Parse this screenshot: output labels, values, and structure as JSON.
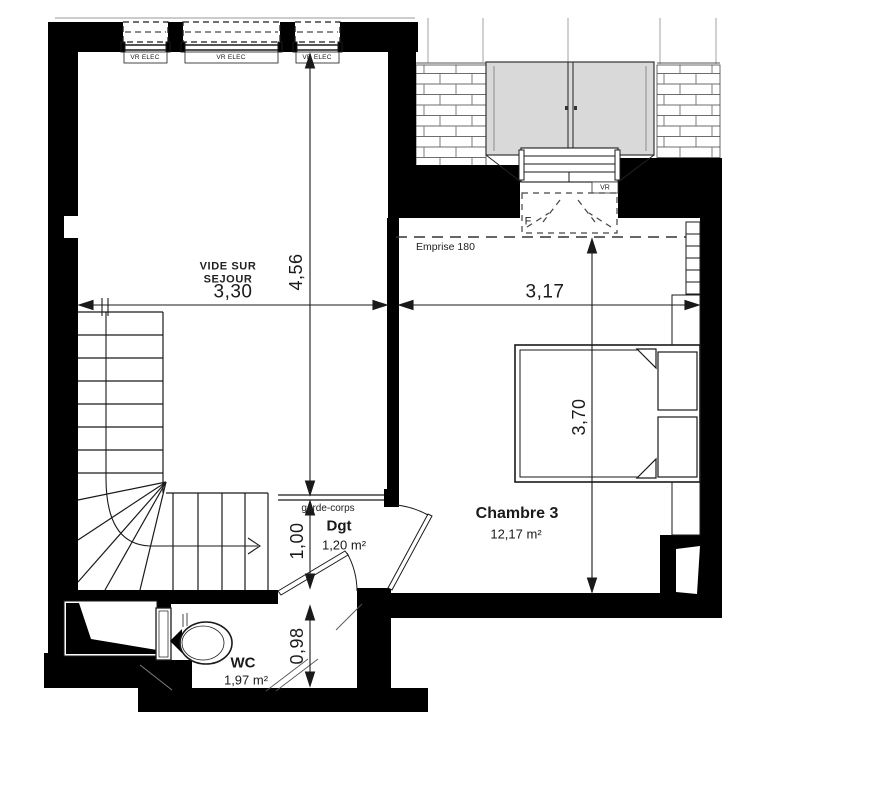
{
  "plan": {
    "type": "floor-plan",
    "rooms": {
      "vide_sur_sejour": {
        "name_line1": "VIDE SUR",
        "name_line2": "SEJOUR"
      },
      "chambre3": {
        "name": "Chambre 3",
        "area": "12,17 m²"
      },
      "dgt": {
        "name": "Dgt",
        "area": "1,20 m²"
      },
      "wc": {
        "name": "WC",
        "area": "1,97 m²"
      }
    },
    "dimensions": {
      "d330": "3,30",
      "d456": "4,56",
      "d317": "3,17",
      "d370": "3,70",
      "d100": "1,00",
      "d098": "0,98"
    },
    "labels": {
      "emprise": "Emprise 180",
      "garde_corps": "garde-corps",
      "window_type": "F",
      "roller_shutter": "VR"
    },
    "windows": [
      {
        "label": "VR ELEC"
      },
      {
        "label": "VR ELEC"
      },
      {
        "label": "VR ELEC"
      }
    ],
    "colors": {
      "wall": "#000000",
      "line": "#1a1a1a",
      "panel_gray": "#d9d9d9",
      "mortar": "#6e6e6e",
      "ghost": "#999999"
    }
  }
}
